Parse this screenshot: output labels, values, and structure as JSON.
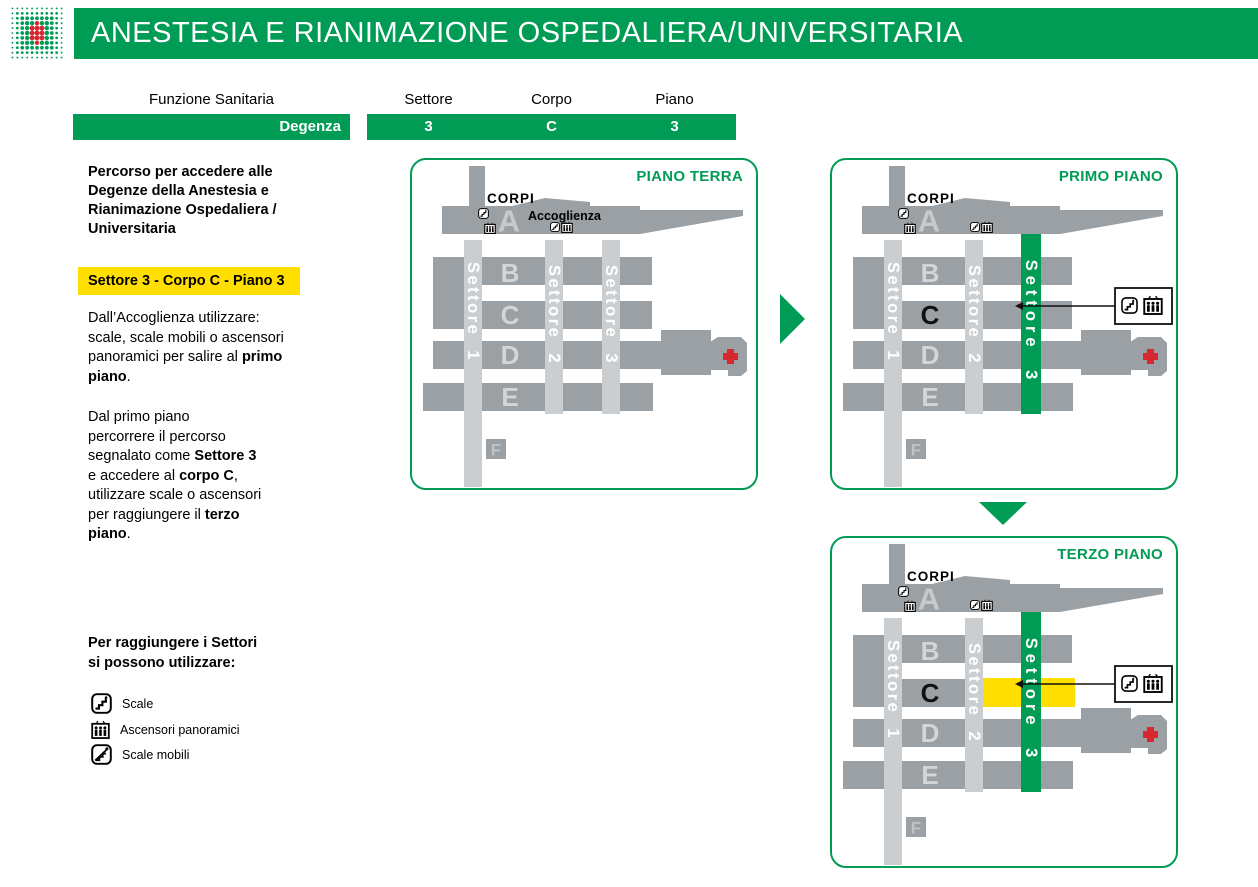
{
  "colors": {
    "green": "#009B55",
    "yellow": "#FFDE00",
    "red": "#D7282F",
    "building": "#9BA0A4",
    "sector": "#CBCED0",
    "letter": "#D3D5D7",
    "letter-a": "#C7CACC",
    "letter-f": "#C0C3C5"
  },
  "header": {
    "title": "ANESTESIA E RIANIMAZIONE OSPEDALIERA/UNIVERSITARIA"
  },
  "route_table": {
    "function_header": "Funzione Sanitaria",
    "function_value": "Degenza",
    "sector_header": "Settore",
    "sector_value": "3",
    "body_header": "Corpo",
    "body_value": "C",
    "floor_header": "Piano",
    "floor_value": "3"
  },
  "sidebar": {
    "intro": "Percorso per accedere alle\nDegenze della Anestesia e\nRianimazione Ospedaliera /\nUniversitaria",
    "highlight": "Settore 3 - Corpo C - Piano 3",
    "para1": [
      [
        {
          "t": "Dall’Accoglienza utilizzare:"
        }
      ],
      [
        {
          "t": "scale, scale mobili o ascensori"
        }
      ],
      [
        {
          "t": "panoramici per salire al "
        },
        {
          "t": "primo",
          "b": true
        }
      ],
      [
        {
          "t": "piano",
          "b": true
        },
        {
          "t": "."
        }
      ]
    ],
    "para2": [
      [
        {
          "t": "Dal primo piano"
        }
      ],
      [
        {
          "t": "percorrere il percorso"
        }
      ],
      [
        {
          "t": "segnalato come "
        },
        {
          "t": "Settore 3",
          "b": true
        }
      ],
      [
        {
          "t": "e accedere al "
        },
        {
          "t": "corpo C",
          "b": true
        },
        {
          "t": ","
        }
      ],
      [
        {
          "t": "utilizzare scale o ascensori"
        }
      ],
      [
        {
          "t": "per raggiungere il "
        },
        {
          "t": "terzo",
          "b": true
        }
      ],
      [
        {
          "t": "piano",
          "b": true
        },
        {
          "t": "."
        }
      ]
    ],
    "legend_title": "Per raggiungere i Settori\nsi possono utilizzare:",
    "legend": [
      {
        "icon": "stairs-icon",
        "label": "Scale"
      },
      {
        "icon": "panoramic-elevator-icon",
        "label": "Ascensori panoramici"
      },
      {
        "icon": "escalator-icon",
        "label": "Scale mobili"
      }
    ]
  },
  "maps": {
    "corpi_label": "CORPI",
    "accoglienza_label": "Accoglienza",
    "bodies": {
      "a": "A",
      "b": "B",
      "c": "C",
      "d": "D",
      "e": "E",
      "f": "F"
    },
    "sectors": {
      "s1": "Settore 1",
      "s2": "Settore 2",
      "s3": "Settore 3"
    },
    "panels": [
      {
        "title": "PIANO TERRA"
      },
      {
        "title": "PRIMO PIANO"
      },
      {
        "title": "TERZO PIANO"
      }
    ]
  }
}
